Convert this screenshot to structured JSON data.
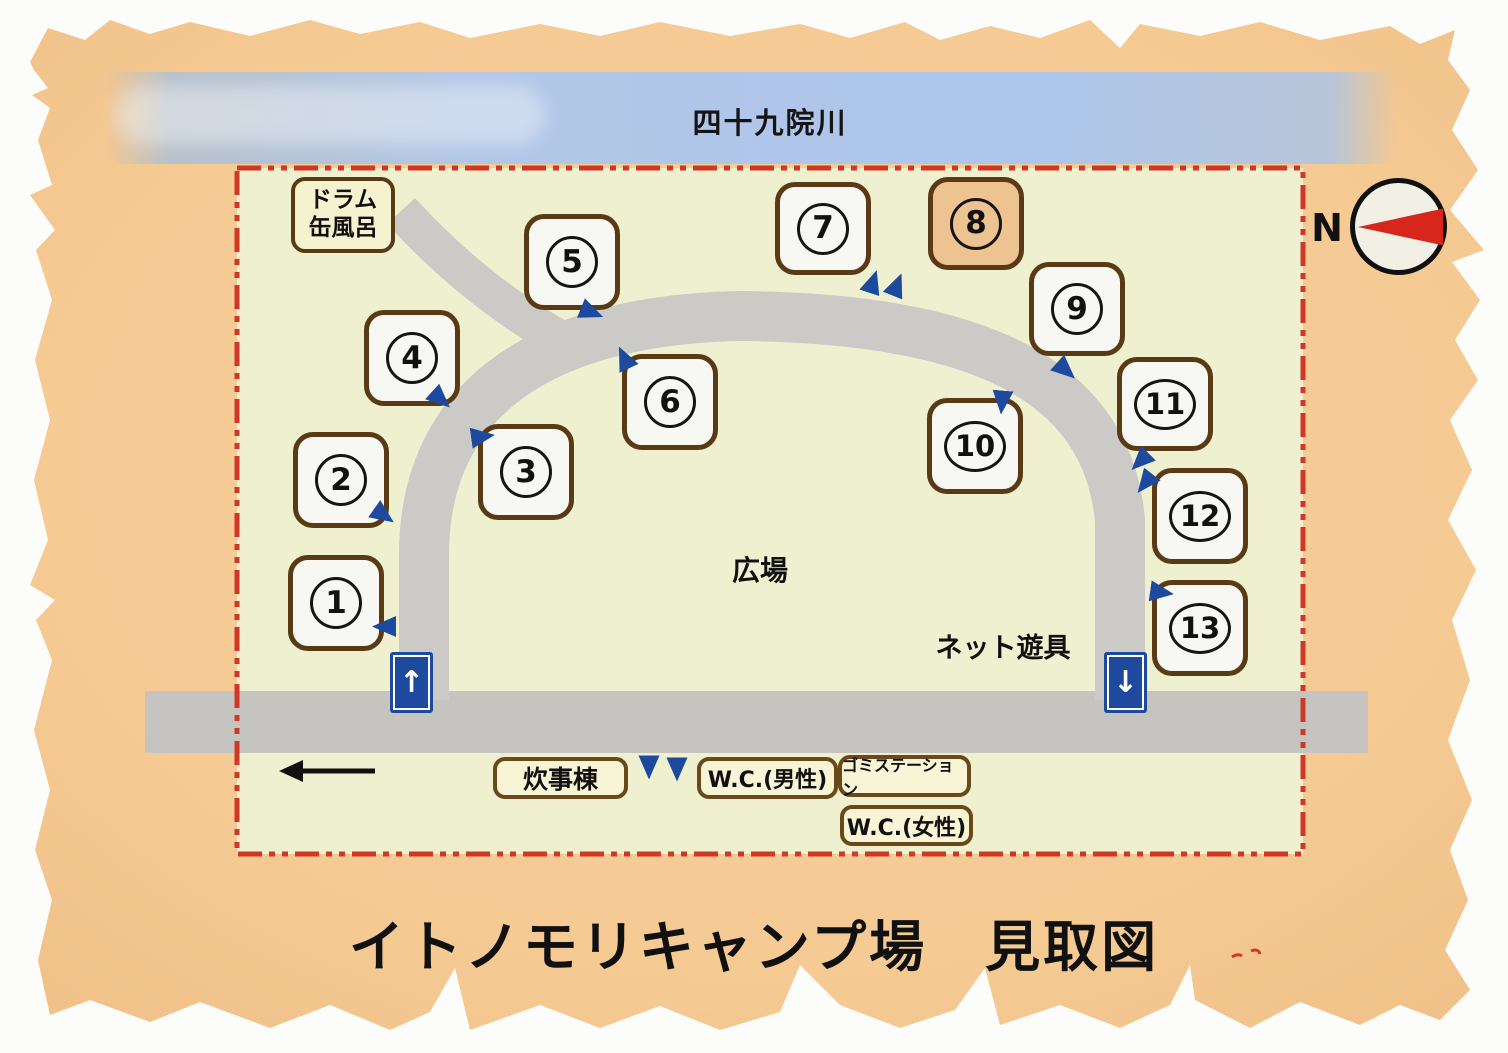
{
  "title": "イトノモリキャンプ場　見取図",
  "river": {
    "label": "四十九院川"
  },
  "compass": {
    "label": "N"
  },
  "drum_bath": {
    "line1": "ドラム",
    "line2": "缶風呂"
  },
  "areas": {
    "plaza": "広場",
    "net_playground": "ネット遊具"
  },
  "facilities": {
    "cooking_hall": "炊事棟",
    "wc_male": "W.C.(男性)",
    "garbage_station": "ゴミステーション",
    "wc_female": "W.C.(女性)"
  },
  "signs": {
    "entrance_up_arrow": "↑",
    "exit_down_arrow": "↓"
  },
  "sites": [
    "1",
    "2",
    "3",
    "4",
    "5",
    "6",
    "7",
    "8",
    "9",
    "10",
    "11",
    "12",
    "13"
  ],
  "colors": {
    "paper": "#f5c992",
    "field_green": "#eef0cf",
    "river_blue": "#aec6e8",
    "road_gray": "#c9c8c5",
    "boundary_red": "#d03826",
    "box_border_brown": "#5a3a14",
    "site_fill": "#f7f7f4",
    "site8_fill": "#edc391",
    "facility_fill": "#f8f4d6",
    "sign_blue": "#1d4a9e",
    "needle_red": "#d7271d"
  }
}
